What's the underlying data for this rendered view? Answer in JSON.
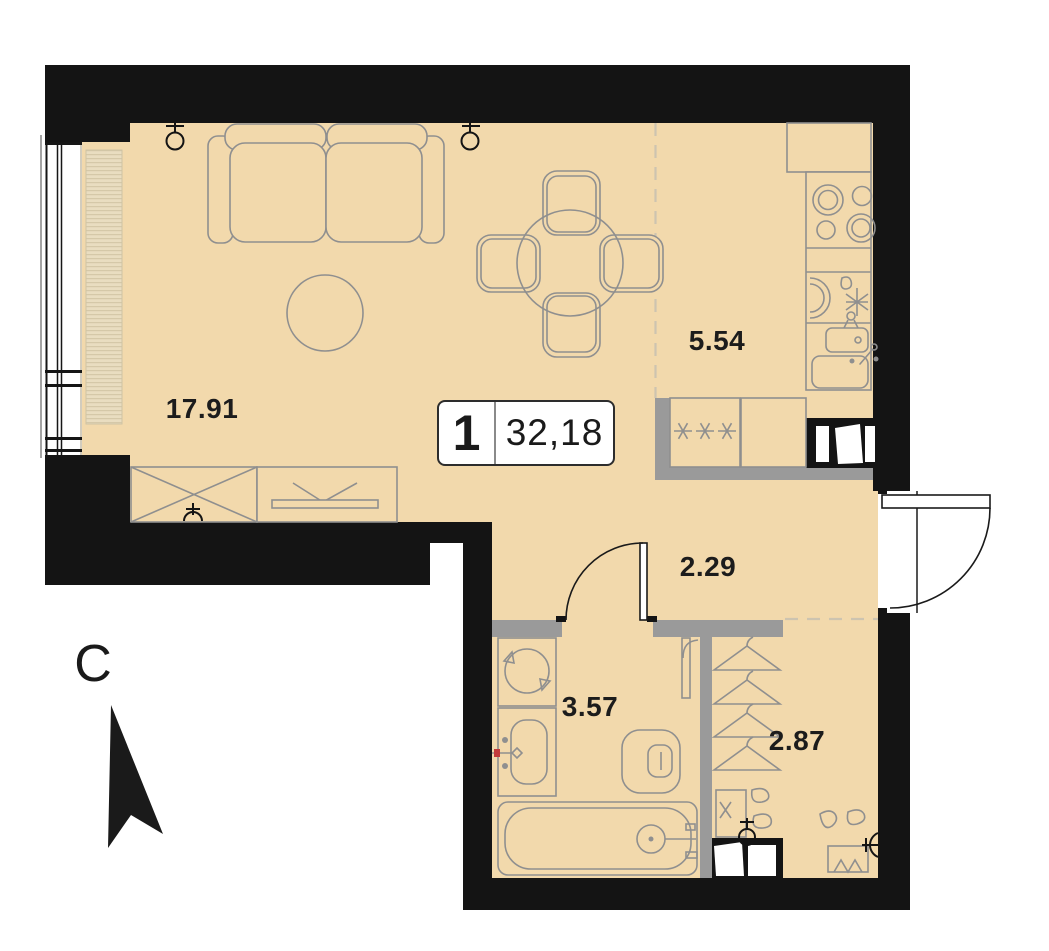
{
  "floorplan": {
    "unit_badge": {
      "room_count": "1",
      "total_area": "32,18"
    },
    "areas": {
      "living_room": "17.91",
      "kitchen": "5.54",
      "hallway": "2.29",
      "bathroom": "3.57",
      "wardrobe": "2.87"
    },
    "compass": {
      "north": "С"
    },
    "colors": {
      "floor": "#f2d9ac",
      "wall": "#141414",
      "partition": "#9a9a9a",
      "furniture_line": "#8f8f8f",
      "hatch_bg": "#e9ddc0",
      "dashed_line": "#cdc4b0"
    },
    "furniture_icons": [
      "sofa",
      "round-rug",
      "dining-table",
      "dining-chairs",
      "tv-stand",
      "wardrobe-cabinet",
      "kitchen-counter",
      "stove",
      "kitchen-sink",
      "fridge",
      "ventilation-shaft",
      "washing-machine",
      "bathroom-sink",
      "toilet",
      "bathtub",
      "coat-hangers",
      "shoes",
      "shoe-bench",
      "entrance-door",
      "interior-door",
      "bathroom-door",
      "north-arrow",
      "outlet-symbols"
    ]
  }
}
